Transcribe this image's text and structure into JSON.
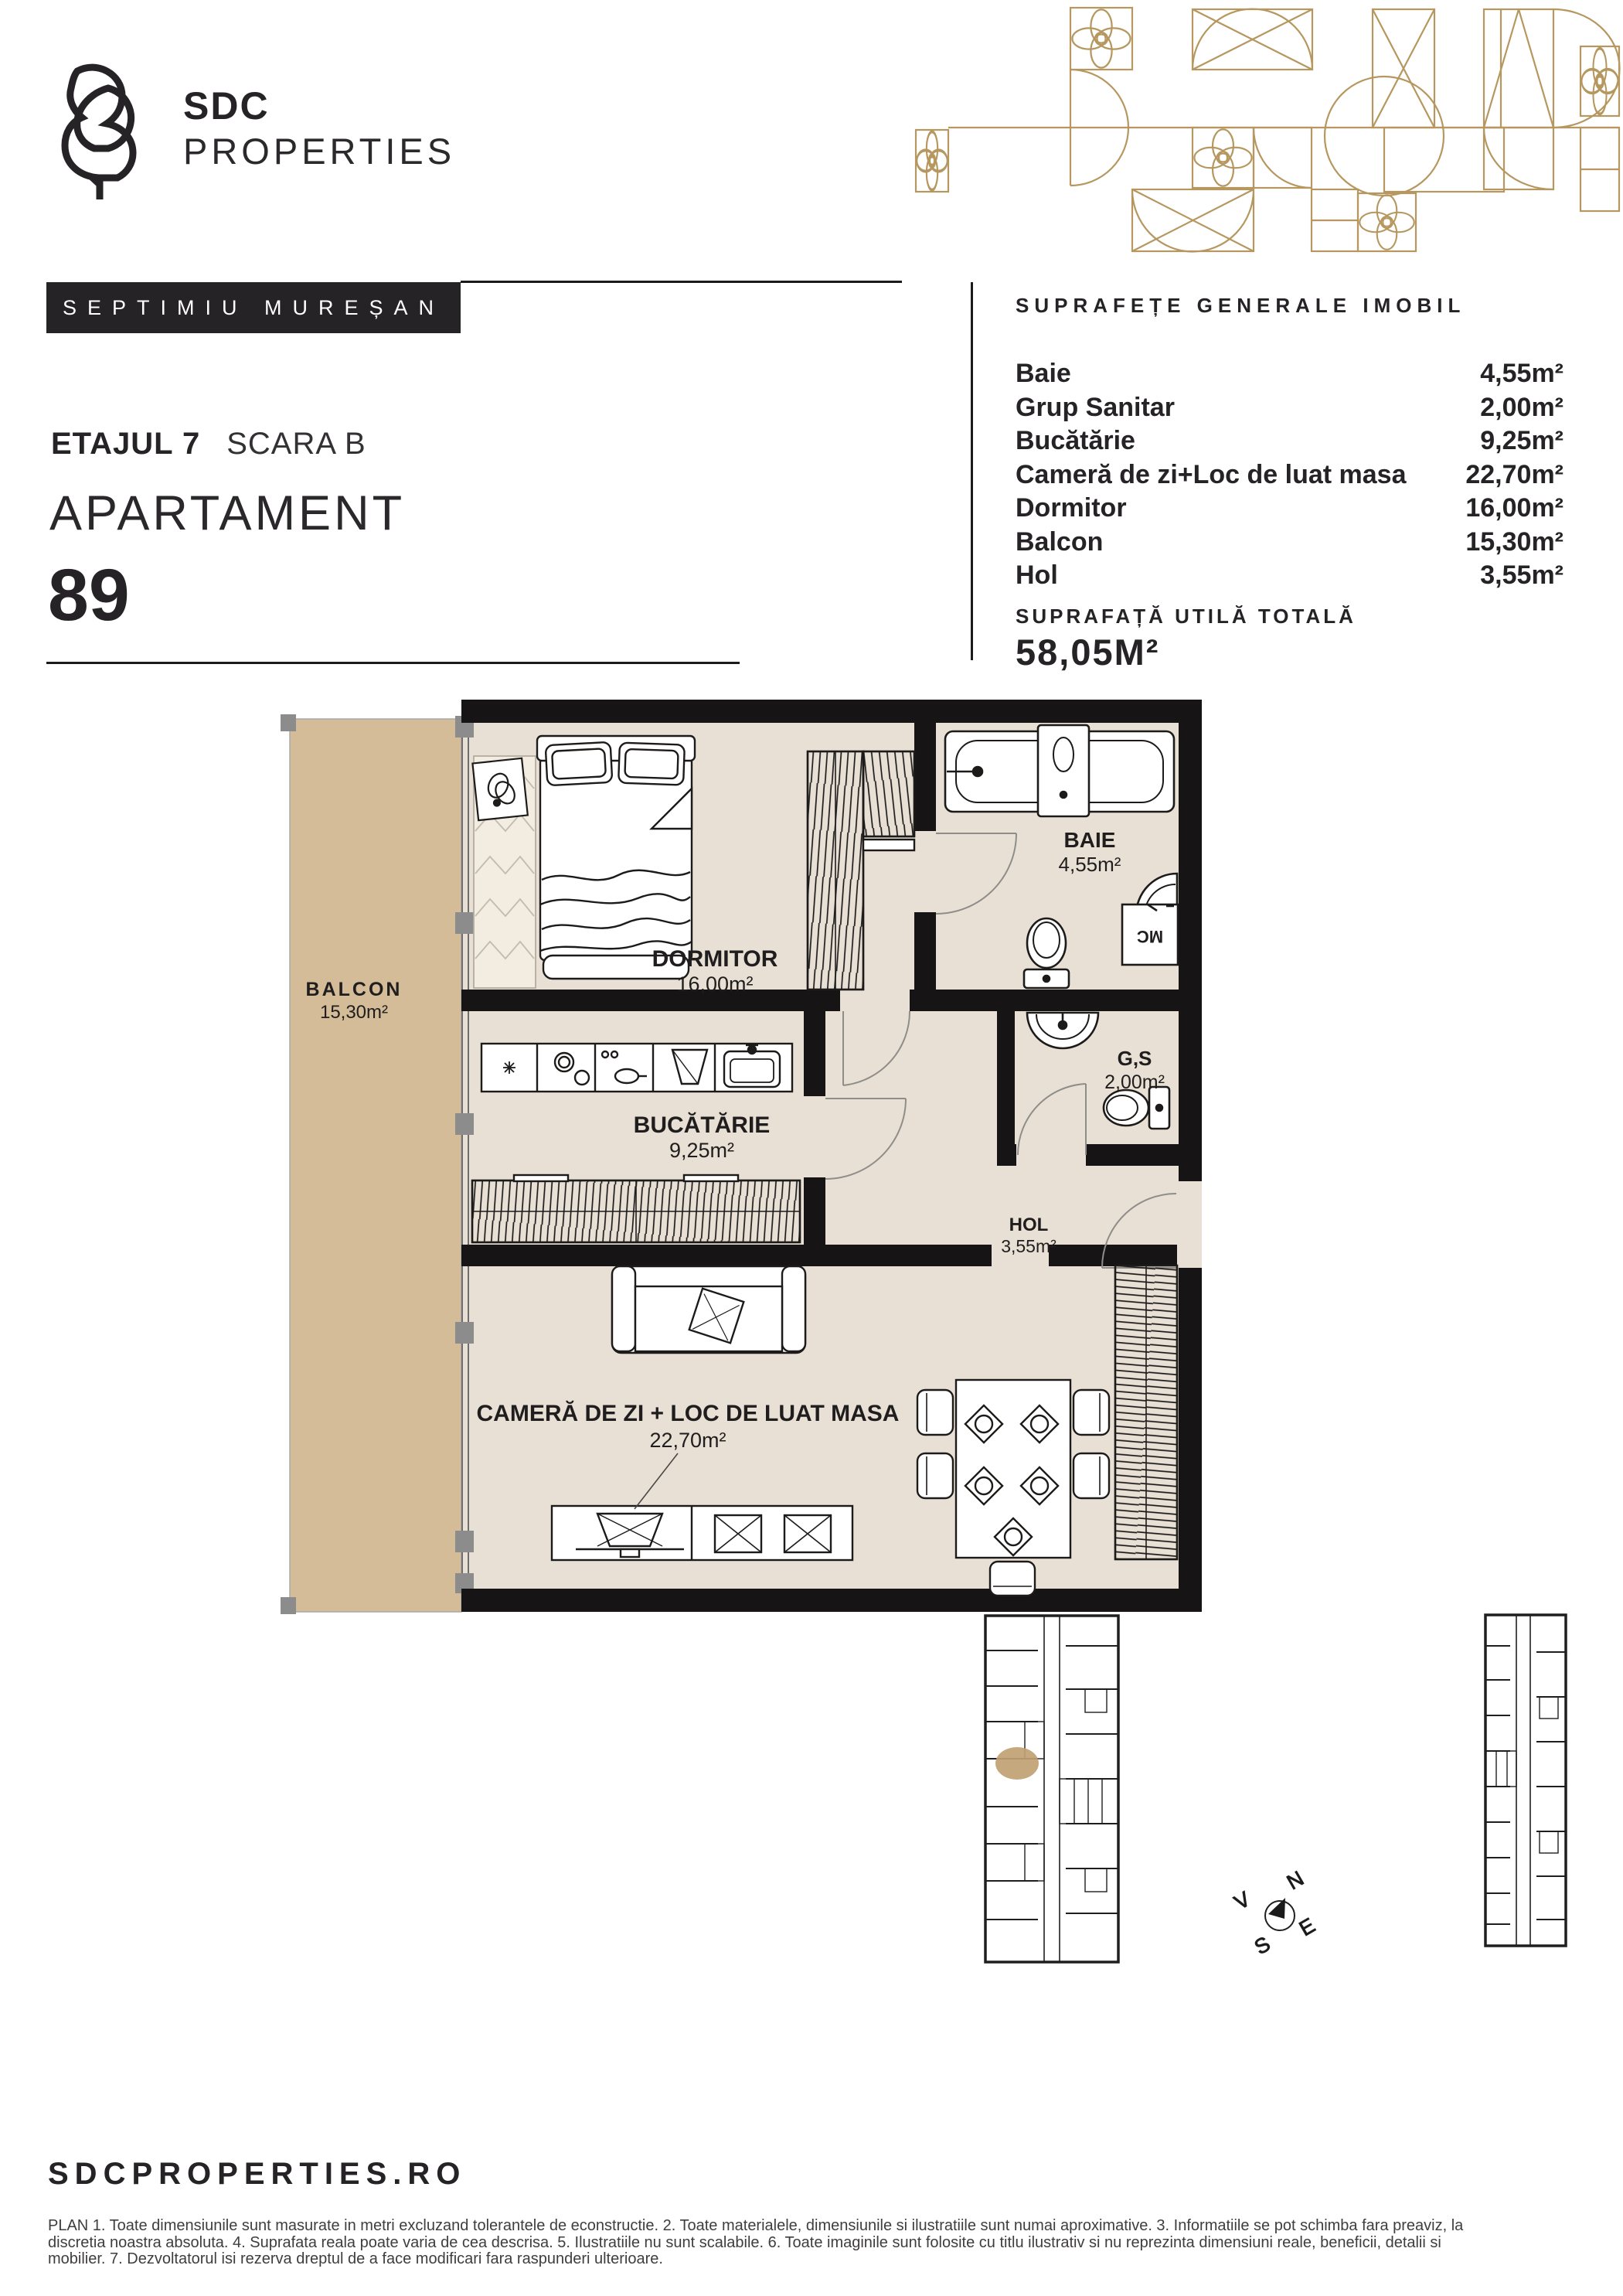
{
  "brand": {
    "name_top": "SDC",
    "name_bottom": "PROPERTIES"
  },
  "developer_badge": "SEPTIMIU MUREȘAN",
  "unit": {
    "floor_label": "ETAJUL 7",
    "stair_label": "SCARA B",
    "type_label": "APARTAMENT",
    "number": "89"
  },
  "areas": {
    "heading": "SUPRAFEȚE GENERALE IMOBIL",
    "rows": [
      {
        "label": "Baie",
        "value": "4,55m²"
      },
      {
        "label": "Grup Sanitar",
        "value": "2,00m²"
      },
      {
        "label": "Bucătărie",
        "value": "9,25m²"
      },
      {
        "label": "Cameră de zi+Loc de luat masa",
        "value": "22,70m²"
      },
      {
        "label": "Dormitor",
        "value": "16,00m²"
      },
      {
        "label": "Balcon",
        "value": "15,30m²"
      },
      {
        "label": "Hol",
        "value": "3,55m²"
      }
    ],
    "total_heading": "SUPRAFAȚĂ UTILĂ TOTALĂ",
    "total_value": "58,05M²"
  },
  "plan": {
    "rooms": {
      "dormitor": {
        "name": "DORMITOR",
        "area": "16,00m²"
      },
      "baie": {
        "name": "BAIE",
        "area": "4,55m²"
      },
      "bucatarie": {
        "name": "BUCĂTĂRIE",
        "area": "9,25m²"
      },
      "gs": {
        "name": "G,S",
        "area": "2,00m²"
      },
      "hol": {
        "name": "HOL",
        "area": "3,55m²"
      },
      "balcon": {
        "name": "BALCON",
        "area": "15,30m²"
      },
      "living": {
        "name": "CAMERĂ DE ZI + LOC DE LUAT MASA",
        "area": "22,70m²"
      }
    },
    "washing_machine_label": "MC"
  },
  "compass": {
    "n": "N",
    "e": "E",
    "s": "S",
    "v": "V"
  },
  "footer": {
    "website": "SDCPROPERTIES.RO",
    "disclaimer_lines": [
      "PLAN 1. Toate dimensiunile sunt masurate in metri excluzand tolerantele de econstructie. 2. Toate materialele, dimensiunile si ilustratiile sunt numai aproximative. 3. Informatiile se pot schimba fara preaviz, la",
      "discretia noastra absoluta. 4. Suprafata reala poate varia de cea descrisa. 5. Ilustratiile nu sunt scalabile. 6. Toate imaginile sunt folosite cu titlu ilustrativ si nu reprezinta dimensiuni reale, beneficii, detalii si",
      "mobilier. 7. Dezvoltatorul isi rezerva dreptul de a face modificari fara raspunderi ulterioare."
    ]
  },
  "colors": {
    "accent_gold": "#b6975f",
    "wall": "#161414",
    "floor": "#e8e0d4",
    "balcony": "#d4bc98",
    "unit_highlight": "#c1a173",
    "text": "#262326"
  }
}
